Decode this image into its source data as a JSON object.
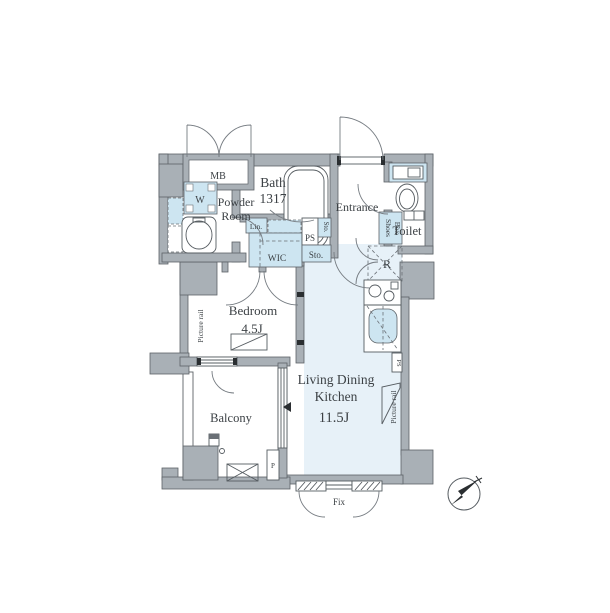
{
  "colors": {
    "wall_gray": "#a9b0b6",
    "outline": "#5c6267",
    "ldk_floor_blue": "#e7f1f8",
    "fixture_blue": "#cde5f1",
    "text": "#3c4145"
  },
  "rooms": {
    "mb": {
      "label": "MB"
    },
    "powder_room": {
      "line1": "Powder",
      "line2": "Room"
    },
    "bath": {
      "line1": "Bath",
      "line2": "1317"
    },
    "entrance": {
      "label": "Entrance"
    },
    "toilet": {
      "label": "Toilet"
    },
    "bedroom": {
      "label": "Bedroom",
      "size": "4.5J"
    },
    "ldk": {
      "line1": "Living Dining",
      "line2": "Kitchen",
      "size": "11.5J"
    },
    "balcony": {
      "label": "Balcony"
    }
  },
  "storage": {
    "wic": "WIC",
    "linen": "Lin.",
    "sto_small_vertical": "Sto.",
    "sto_main": "Sto.",
    "shoes_line1": "Shoes",
    "shoes_line2": "Box",
    "refrigerator": "R"
  },
  "labels": {
    "washer": "W",
    "ps_hall": "PS",
    "ps_kitchen": "PS",
    "pipe": "P",
    "fix_window": "Fix",
    "picture_rail_left": "Picture rail",
    "picture_rail_right": "Picture rail"
  }
}
